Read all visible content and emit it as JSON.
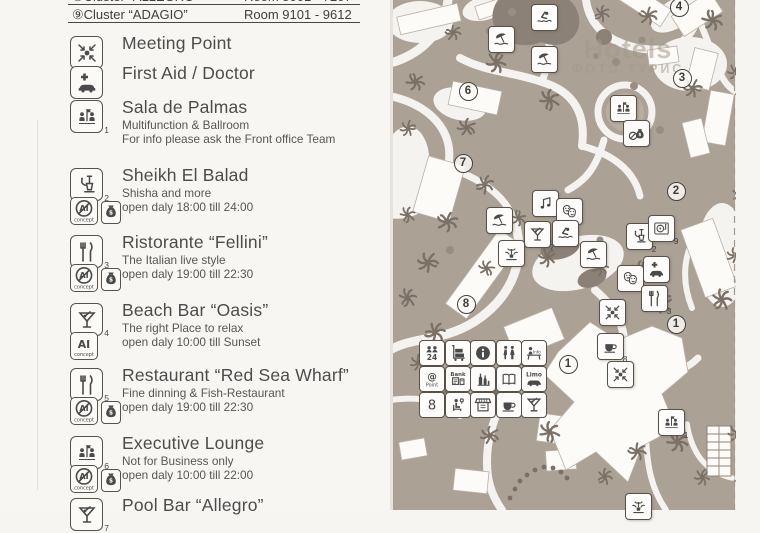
{
  "header": {
    "rows": [
      {
        "name": "⑧Cluster “ALLEGRO”",
        "rooms": "Room 8001 - 7207"
      },
      {
        "name": "⑨Cluster “ADAGIO”",
        "rooms": "Room 9101 - 9612"
      }
    ]
  },
  "legend": {
    "items": [
      {
        "icon": "meeting",
        "num": "",
        "title": "Meeting Point",
        "lines": [],
        "flags": []
      },
      {
        "icon": "firstaid",
        "num": "",
        "title": "First Aid / Doctor",
        "lines": [],
        "flags": []
      },
      {
        "icon": "people",
        "num": "1",
        "title": "Sala de Palmas",
        "lines": [
          "Multifunction & Ballroom",
          "For info please ask the Front office Team"
        ],
        "flags": []
      },
      {
        "icon": "shisha",
        "num": "2",
        "title": "Sheikh El Balad",
        "lines": [
          "Shisha and more",
          "open daly  18:00 till 24:00"
        ],
        "flags": [
          "notai",
          "money"
        ]
      },
      {
        "icon": "cutlery",
        "num": "3",
        "title": "Ristorante “Fellini”",
        "lines": [
          "The Italian live style",
          "open daly 19:00 till 22:30"
        ],
        "flags": [
          "notai",
          "money"
        ]
      },
      {
        "icon": "martini",
        "num": "4",
        "title": "Beach Bar “Oasis”",
        "lines": [
          "The right Place to relax",
          "open daly 10:00 till Sunset"
        ],
        "flags": [
          "ai"
        ]
      },
      {
        "icon": "cutlery",
        "num": "5",
        "title": "Restaurant “Red Sea Wharf”",
        "lines": [
          "Fine dinning & Fish-Restaurant",
          "open daly 19:00 till 22:30"
        ],
        "flags": [
          "notai",
          "money"
        ]
      },
      {
        "icon": "people",
        "num": "6",
        "title": "Executive Lounge",
        "lines": [
          "Not for Business only",
          "open daly 10:00 till 22:00"
        ],
        "flags": [
          "notai",
          "money"
        ]
      },
      {
        "icon": "martini",
        "num": "7",
        "title": "Pool Bar “Allegro”",
        "lines": [],
        "flags": []
      }
    ]
  },
  "map": {
    "watermark": {
      "line1": "Hotels",
      "line2": "ФОТО ТУРИС"
    },
    "numbers": [
      {
        "n": "4",
        "x": 288,
        "y": 6
      },
      {
        "n": "3",
        "x": 291,
        "y": 77
      },
      {
        "n": "6",
        "x": 77,
        "y": 90
      },
      {
        "n": "7",
        "x": 72,
        "y": 162
      },
      {
        "n": "2",
        "x": 285,
        "y": 190
      },
      {
        "n": "8",
        "x": 75,
        "y": 303
      },
      {
        "n": "1",
        "x": 285,
        "y": 323
      },
      {
        "n": "1",
        "x": 177,
        "y": 363
      }
    ],
    "icons": [
      {
        "type": "swimmer",
        "num": "",
        "x": 153,
        "y": 16
      },
      {
        "type": "umbrella",
        "num": "",
        "x": 110,
        "y": 38
      },
      {
        "type": "umbrella",
        "num": "",
        "x": 153,
        "y": 58
      },
      {
        "type": "people",
        "num": "",
        "x": 232,
        "y": 107
      },
      {
        "type": "nomoney",
        "num": "",
        "x": 245,
        "y": 132
      },
      {
        "type": "music",
        "num": "",
        "x": 154,
        "y": 202
      },
      {
        "type": "masks",
        "num": "",
        "x": 178,
        "y": 210
      },
      {
        "type": "umbrella",
        "num": "",
        "x": 108,
        "y": 219
      },
      {
        "type": "martini",
        "num": "7",
        "x": 146,
        "y": 233
      },
      {
        "type": "swimmer",
        "num": "",
        "x": 174,
        "y": 232
      },
      {
        "type": "fountain",
        "num": "",
        "x": 120,
        "y": 252
      },
      {
        "type": "umbrella",
        "num": "",
        "x": 202,
        "y": 253
      },
      {
        "type": "shisha",
        "num": "2",
        "x": 248,
        "y": 235
      },
      {
        "type": "turntable",
        "num": "9",
        "x": 270,
        "y": 227
      },
      {
        "type": "masks",
        "num": "",
        "x": 239,
        "y": 277
      },
      {
        "type": "firstaid",
        "num": "",
        "x": 265,
        "y": 268
      },
      {
        "type": "cutlery",
        "num": "3",
        "x": 263,
        "y": 297
      },
      {
        "type": "meeting",
        "num": "",
        "x": 221,
        "y": 311
      },
      {
        "type": "coffee",
        "num": "8",
        "x": 219,
        "y": 345
      },
      {
        "type": "meeting",
        "num": "",
        "x": 229,
        "y": 373
      },
      {
        "type": "people",
        "num": "1",
        "x": 280,
        "y": 421
      },
      {
        "type": "fountain",
        "num": "",
        "x": 247,
        "y": 505
      }
    ],
    "amenities": {
      "rows": [
        [
          "reception",
          "luggage",
          "info",
          "wc",
          "infodesk"
        ],
        [
          "atpoint",
          "bank",
          "shop",
          "book",
          "limo"
        ],
        [
          "eight",
          "hairdresser",
          "kiosk",
          "coffee",
          "martini"
        ]
      ]
    }
  },
  "colors": {
    "paper": "#f7f5f2",
    "ink": "#4a4a4a",
    "land": "#aba195",
    "pool": "#8c8177",
    "palm": "#7a7066"
  }
}
